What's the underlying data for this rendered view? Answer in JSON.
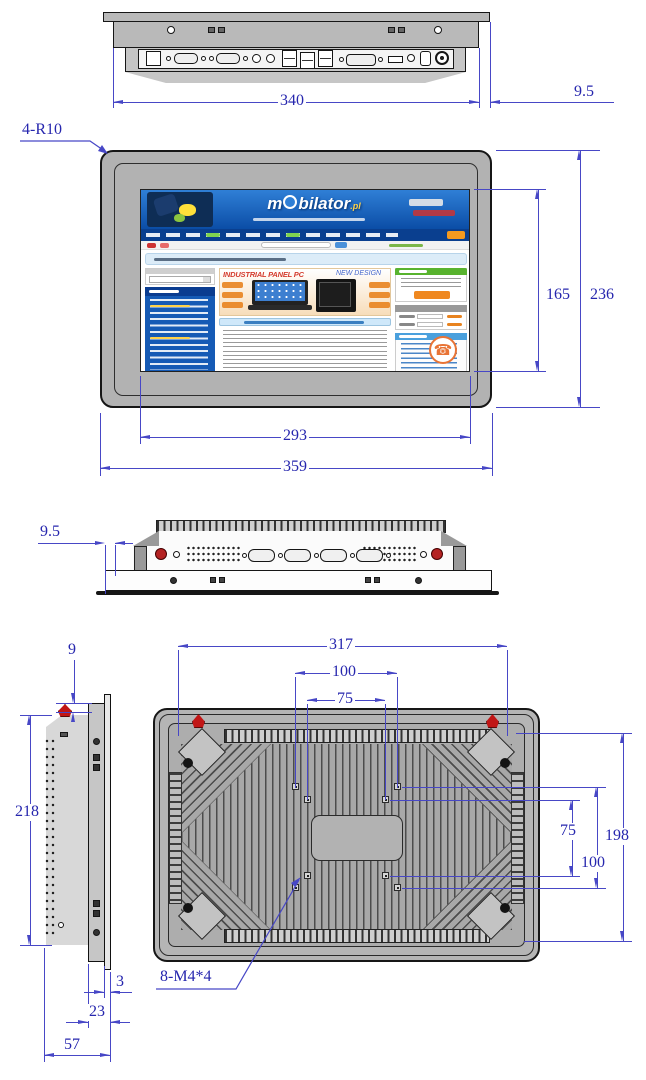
{
  "drawing": {
    "top_view": {
      "dim_width": "340",
      "dim_overhang": "9.5"
    },
    "front_view": {
      "label_corner_radius": "4-R10",
      "dim_screen_height": "165",
      "dim_total_height": "236",
      "dim_screen_width": "293",
      "dim_total_width": "359"
    },
    "side_view": {
      "dim_overhang": "9.5"
    },
    "profile_view": {
      "dim_front_offset": "9",
      "dim_body_height": "218",
      "dim_glass": "3",
      "dim_bezel_depth": "23",
      "dim_total_depth": "57"
    },
    "rear_view": {
      "dim_mount_width": "317",
      "dim_vesa_100_h": "100",
      "dim_vesa_75_h": "75",
      "dim_vesa_75_v": "75",
      "dim_vesa_100_v": "100",
      "dim_mount_height": "198",
      "label_mount_holes": "8-M4*4"
    }
  },
  "screen_content": {
    "logo_prefix": "m",
    "logo_suffix": "bilator",
    "logo_tld": ".pl",
    "banner_title": "INDUSTRIAL PANEL PC",
    "banner_subtitle": "NEW DESIGN",
    "phone_glyph": "☎"
  },
  "colors": {
    "dimension_line": "#4747c6",
    "dimension_text": "#2626ae",
    "bezel_gray": "#b2b2b2",
    "header_blue": "#1a66c2",
    "nav_blue": "#0a3f8f",
    "sidebar_blue": "#155ab5",
    "accent_orange": "#ef8820",
    "accent_green": "#58b32e",
    "phone_orange": "#e87436",
    "screw_red": "#c11616"
  }
}
